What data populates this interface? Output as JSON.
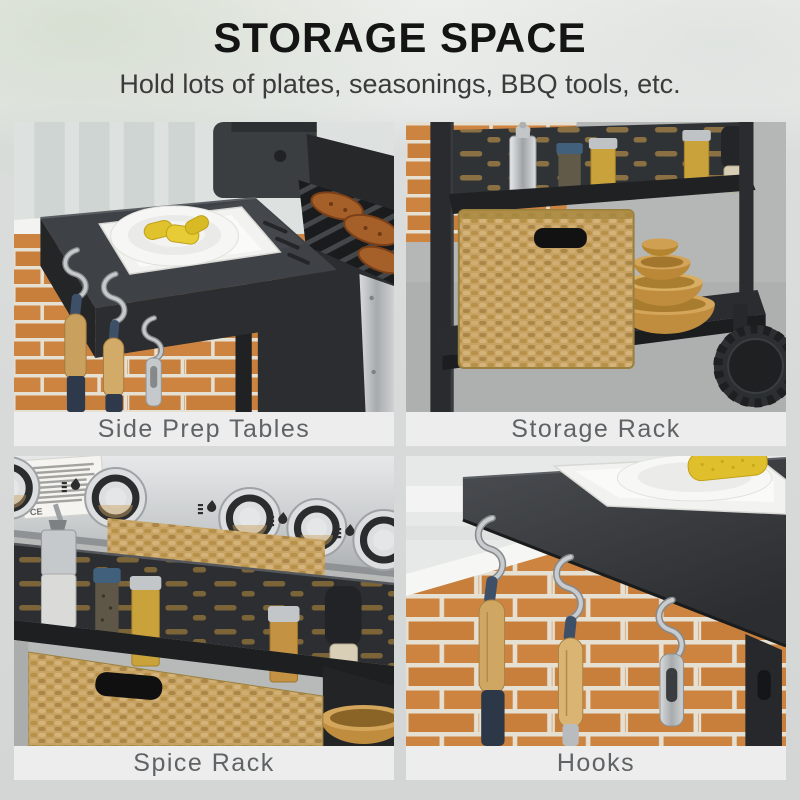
{
  "header": {
    "title": "STORAGE SPACE",
    "subtitle": "Hold lots of plates, seasonings, BBQ tools, etc."
  },
  "panels": [
    {
      "id": "side-prep-tables",
      "caption": "Side Prep Tables",
      "scene": "black side prep table holding a white square plate and round plate with grilled corn, S-hooks with wooden-handled tools below, grill grates with steaks at right, brick wall background"
    },
    {
      "id": "storage-rack",
      "caption": "Storage Rack",
      "scene": "upper slotted rack holding oil bottle, spice jars and pepper grinder; wicker basket and stacked wooden bowls on bottom shelf; cart wheel at lower right"
    },
    {
      "id": "spice-rack",
      "caption": "Spice Rack",
      "ce_mark": "CE",
      "scene": "stainless control panel with chrome burner knobs and flame icons above a black slotted spice rack holding oil bottle, blue-cap jar, spice jars and pepper grinder; wicker basket below"
    },
    {
      "id": "hooks",
      "caption": "Hooks",
      "scene": "three chrome S-hooks hanging from the side table edge holding two wooden-handled tools with blue straps and a stainless opener, brick wall background"
    }
  ],
  "colors": {
    "page_bg": "#e9ece9",
    "caption_bg": "#ededee",
    "caption_text": "#606365",
    "title_text": "#141414",
    "subtitle_text": "#3b3b3b",
    "charcoal_table": "#3b3e42",
    "brick_orange": "#cd8440",
    "mortar": "#e6e0d3",
    "wicker_tan": "#c7a263",
    "stainless": "#c6c9cb",
    "corn_yellow": "#dfc02c",
    "wood_bowl": "#c08c3e",
    "hook_chrome": "#c9ccce",
    "handle_wood": "#cfa763",
    "handle_navy": "#3e5068"
  }
}
